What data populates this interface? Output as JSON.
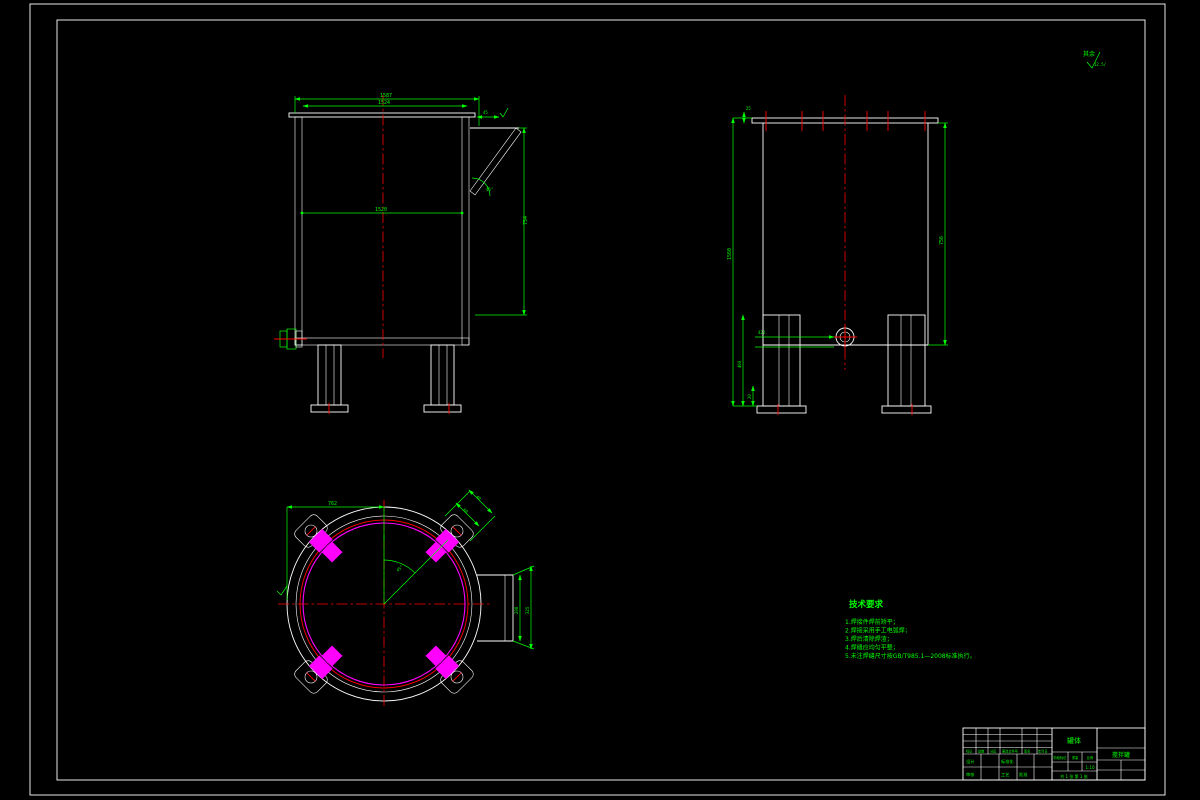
{
  "drawing_meta": {
    "surface_note": "其余",
    "surface_roughness": "12.5/"
  },
  "front_view": {
    "dim_overall_width": "1587",
    "dim_flange_width": "1524",
    "dim_mid_width": "1520",
    "dim_chute_offset": "45",
    "dim_chute_height": "754",
    "dim_chute_angle": "45°"
  },
  "side_view": {
    "dim_overall_height": "1560",
    "dim_lip": "25",
    "dim_body_height": "756",
    "dim_leg_height": "460",
    "dim_foot": "20",
    "dim_outlet_offset": "422"
  },
  "plan_view": {
    "dim_radius": "762",
    "dim_angle": "45°",
    "dim_lug_width": "60",
    "dim_lug_depth": "40",
    "dim_chute_width": "298",
    "dim_chute_depth": "325"
  },
  "tech_req": {
    "title": "技术要求",
    "lines": [
      "1.焊接件焊前矫平；",
      "2.焊接采用手工电弧焊；",
      "3.焊后清除焊渣；",
      "4.焊缝应均匀平整；",
      "5.未注焊缝尺寸按GB/T985.1—2008标准执行。"
    ]
  },
  "title_block": {
    "part_name": "罐体",
    "product_name": "搅拌罐",
    "rev_cols": [
      "标记",
      "处数",
      "分区",
      "更改文件号",
      "签名",
      "年月日"
    ],
    "sign_row1_a": "设计",
    "sign_row1_b": "标准化",
    "sign_row2_a": "审核",
    "sign_row2_b": "工艺",
    "sign_row2_c": "批准",
    "stage_label": "阶段标记",
    "weight_label": "重量",
    "scale_label": "比例",
    "scale_value": "1:10",
    "sheet_info": "共 1 张 第 1 张"
  },
  "colors": {
    "background": "#000000",
    "outline": "#ffffff",
    "dimension": "#00ff00",
    "centerline": "#ff0000",
    "detail": "#ff00ff",
    "hatch": "#7fe8e8"
  }
}
